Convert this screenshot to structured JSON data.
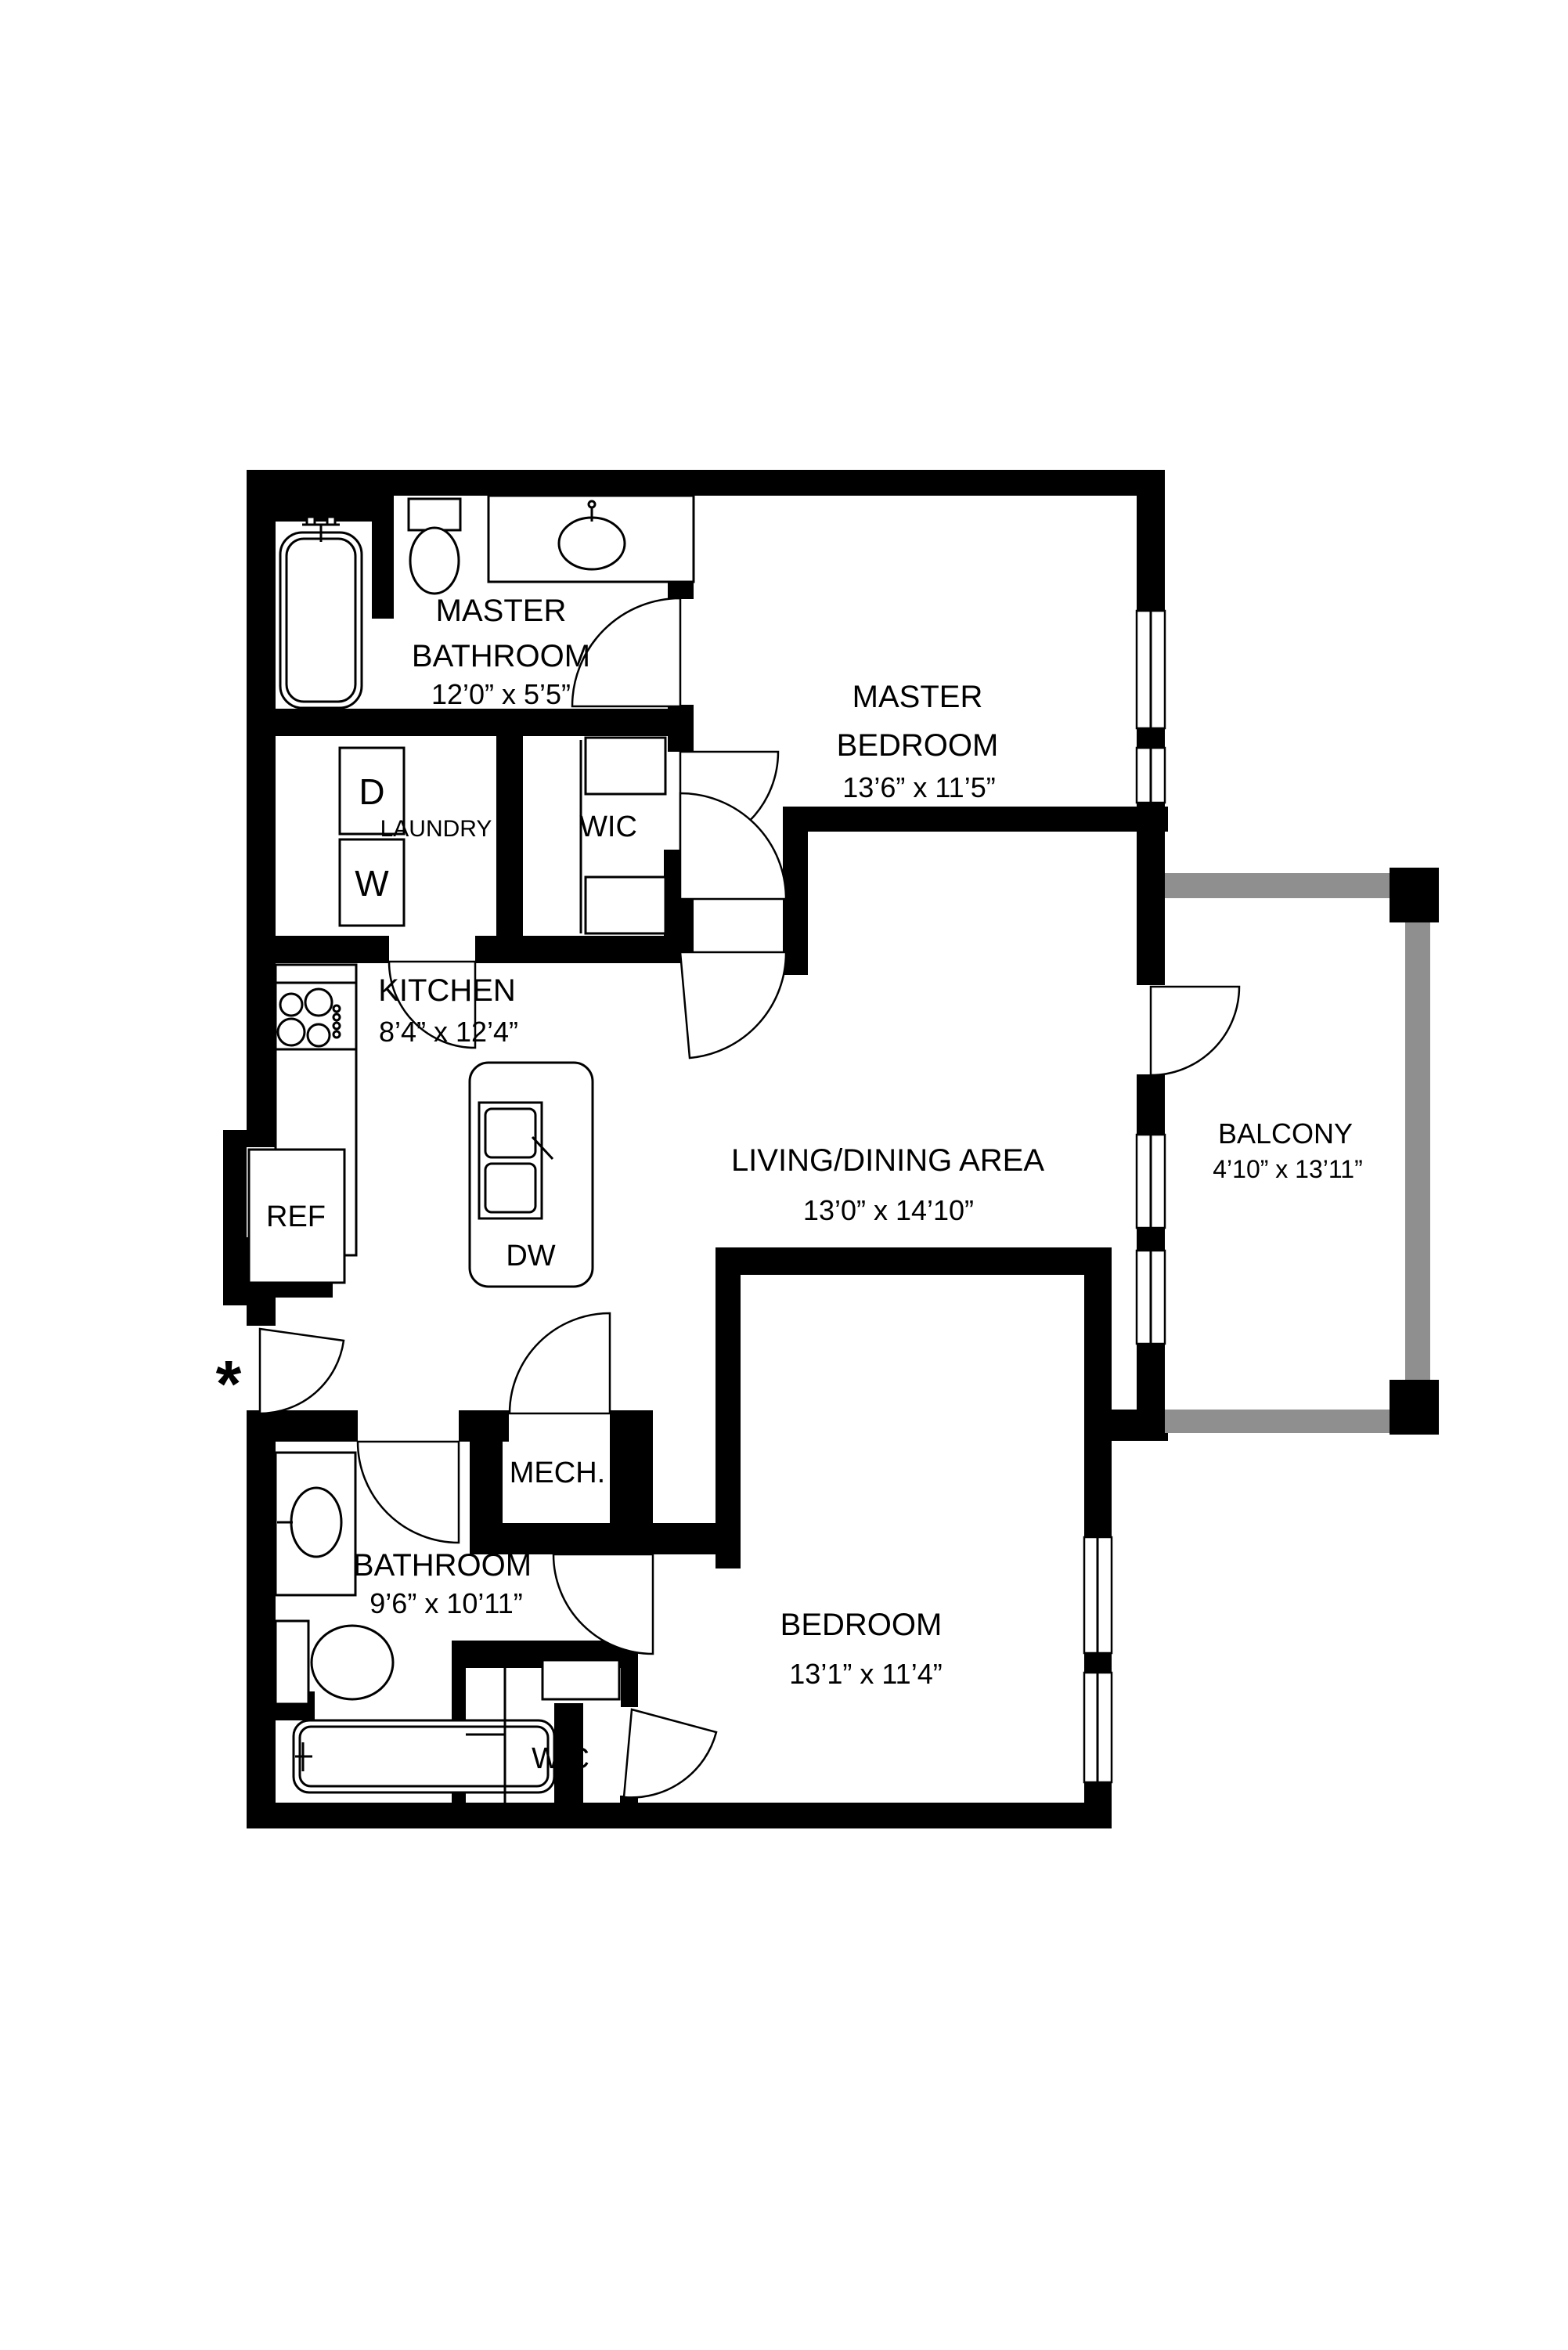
{
  "diagram": {
    "type": "floor-plan",
    "colors": {
      "wall": "#000000",
      "balcony_rail": "#8f8f8f",
      "background": "#ffffff"
    },
    "rooms": {
      "master_bathroom": {
        "line1": "MASTER",
        "line2": "BATHROOM",
        "dims": "12’0” x 5’5”"
      },
      "master_bedroom": {
        "line1": "MASTER",
        "line2": "BEDROOM",
        "dims": "13’6” x 11’5”"
      },
      "laundry": {
        "name": "LAUNDRY"
      },
      "wic_master": {
        "name": "WIC"
      },
      "kitchen": {
        "name": "KITCHEN",
        "dims": "8’4” x 12’4”"
      },
      "living_dining": {
        "name": "LIVING/DINING AREA",
        "dims": "13’0” x 14’10”"
      },
      "balcony": {
        "name": "BALCONY",
        "dims": "4’10” x 13’11”"
      },
      "mech": {
        "name": "MECH."
      },
      "bathroom": {
        "name": "BATHROOM",
        "dims": "9’6” x 10’11”"
      },
      "bedroom": {
        "name": "BEDROOM",
        "dims": "13’1” x 11’4”"
      },
      "wic_bedroom": {
        "name": "WIC"
      }
    },
    "appliances": {
      "dryer": "D",
      "washer": "W",
      "refrigerator": "REF",
      "dishwasher": "DW"
    },
    "annotations": {
      "entry_marker": "*"
    }
  }
}
